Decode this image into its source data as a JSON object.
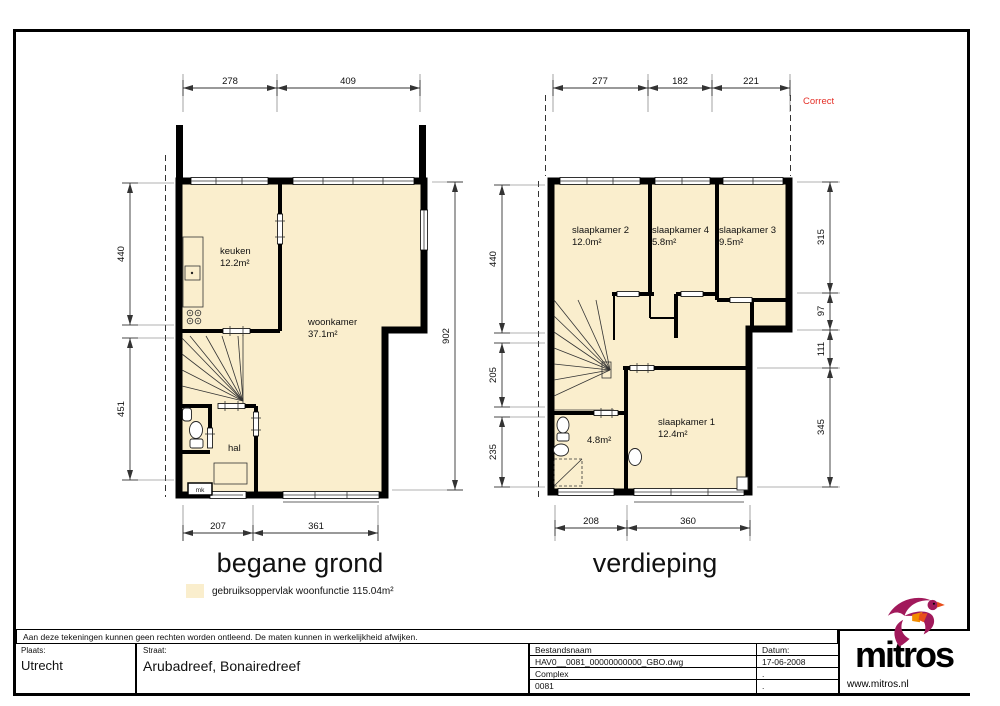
{
  "colors": {
    "floor_fill": "#faeecd",
    "wall": "#000000",
    "note_red": "#e53028",
    "brand_magenta": "#a1195b",
    "brand_orange": "#f28c00",
    "brand_redorange": "#e84e1b"
  },
  "note": {
    "correct": "Correct"
  },
  "ground_floor": {
    "title": "begane grond",
    "legend_label": "gebruiksoppervlak woonfunctie 115.04m²",
    "rooms": [
      {
        "label": "keuken",
        "area": "12.2m²"
      },
      {
        "label": "woonkamer",
        "area": "37.1m²"
      },
      {
        "label": "hal"
      },
      {
        "label": "mk"
      }
    ],
    "dimensions": {
      "top": [
        "278",
        "409"
      ],
      "left": [
        "440",
        "451"
      ],
      "right": [
        "902"
      ],
      "bottom": [
        "207",
        "361"
      ]
    }
  },
  "upper_floor": {
    "title": "verdieping",
    "rooms": [
      {
        "label": "slaapkamer 2",
        "area": "12.0m²"
      },
      {
        "label": "slaapkamer 4",
        "area": "5.8m²"
      },
      {
        "label": "slaapkamer 3",
        "area": "9.5m²"
      },
      {
        "label": "slaapkamer 1",
        "area": "12.4m²"
      },
      {
        "area": "4.8m²"
      }
    ],
    "dimensions": {
      "top": [
        "277",
        "182",
        "221"
      ],
      "left": [
        "440",
        "205",
        "235"
      ],
      "right": [
        "315",
        "97",
        "111",
        "345"
      ],
      "bottom": [
        "208",
        "360"
      ]
    }
  },
  "title_block": {
    "disclaimer": "Aan deze tekeningen kunnen geen rechten worden ontleend. De maten kunnen in werkelijkheid afwijken.",
    "plaats_label": "Plaats:",
    "plaats_value": "Utrecht",
    "straat_label": "Straat:",
    "straat_value": "Arubadreef, Bonairedreef",
    "bestandsnaam_label": "Bestandsnaam",
    "bestandsnaam_value": "HAV0__0081_00000000000_GBO.dwg",
    "complex_label": "Complex",
    "complex_value": "0081",
    "datum_label": "Datum:",
    "datum_value": "17-06-2008",
    "datum_dot1": ".",
    "datum_dot2": "."
  },
  "logo": {
    "name": "mitros",
    "url": "www.mitros.nl"
  }
}
